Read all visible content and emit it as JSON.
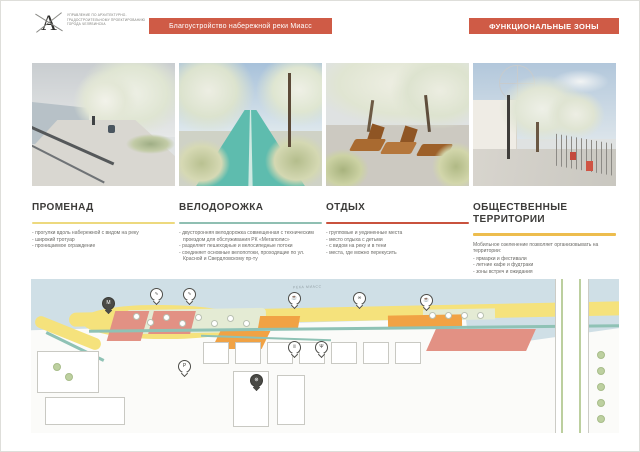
{
  "header": {
    "logo_letter": "А",
    "logo_text": "УПРАВЛЕНИЕ ПО АРХИТЕКТУРНО-ГРАДОСТРОИТЕЛЬНОМУ ПРОЕКТИРОВАНИЮ ГОРОДА ЧЕЛЯБИНСКА",
    "project_title": "Благоустройство набережной реки Миасс",
    "sheet_title": "ФУНКЦИОНАЛЬНЫЕ ЗОНЫ",
    "banner_color": "#cf5b46"
  },
  "zones": [
    {
      "title": "ПРОМЕНАД",
      "rule_color": "#edd97e",
      "bullets": [
        "прогулки вдоль набережной с видом на реку",
        "широкий тротуар",
        "проницаемое ограждение"
      ]
    },
    {
      "title": "ВЕЛОДОРОЖКА",
      "rule_color": "#8fbfb2",
      "bullets": [
        "двусторонняя велодорожка совмещенная с техническим проездом для обслуживания РК «Мегаполис»",
        "разделяет пешеходные и велосипедные потоки",
        "соединяет основные велопотоки, проходящие по ул. Красной и Свердловскому пр-ту"
      ]
    },
    {
      "title": "ОТДЫХ",
      "rule_color": "#c9523e",
      "bullets": [
        "групповые и уединенные места",
        "место отдыха с детьми",
        "с видом на реку и в тени",
        "места, где можно перекусить"
      ]
    },
    {
      "title": "ОБЩЕСТВЕННЫЕ ТЕРРИТОРИИ",
      "rule_color": "#edbd4e",
      "intro": "Мобильное озеленение позволяет организовывать на территории:",
      "bullets": [
        "ярмарки и фестивали",
        "летние кафе и фудтраки",
        "зоны встреч и ожидания"
      ]
    }
  ],
  "map": {
    "river_label": "РЕКА МИАСС",
    "legend_colors": {
      "promenade": "#f5e27c",
      "bike_path": "#8fc2b5",
      "rest": "#e29184",
      "public": "#f1a244",
      "river": "#cfdfe6"
    },
    "markers": [
      {
        "name": "m-object",
        "glyph": "М"
      },
      {
        "name": "lounge-area",
        "glyph": "∿"
      },
      {
        "name": "lounge-area",
        "glyph": "∿"
      },
      {
        "name": "cafe",
        "glyph": "☕"
      },
      {
        "name": "bike-point",
        "glyph": "∞"
      },
      {
        "name": "cafe",
        "glyph": "☕"
      },
      {
        "name": "restroom",
        "glyph": "ii"
      },
      {
        "name": "food",
        "glyph": "Ψ"
      },
      {
        "name": "parking",
        "glyph": "P"
      },
      {
        "name": "ferris-wheel",
        "glyph": "⊛"
      }
    ]
  }
}
